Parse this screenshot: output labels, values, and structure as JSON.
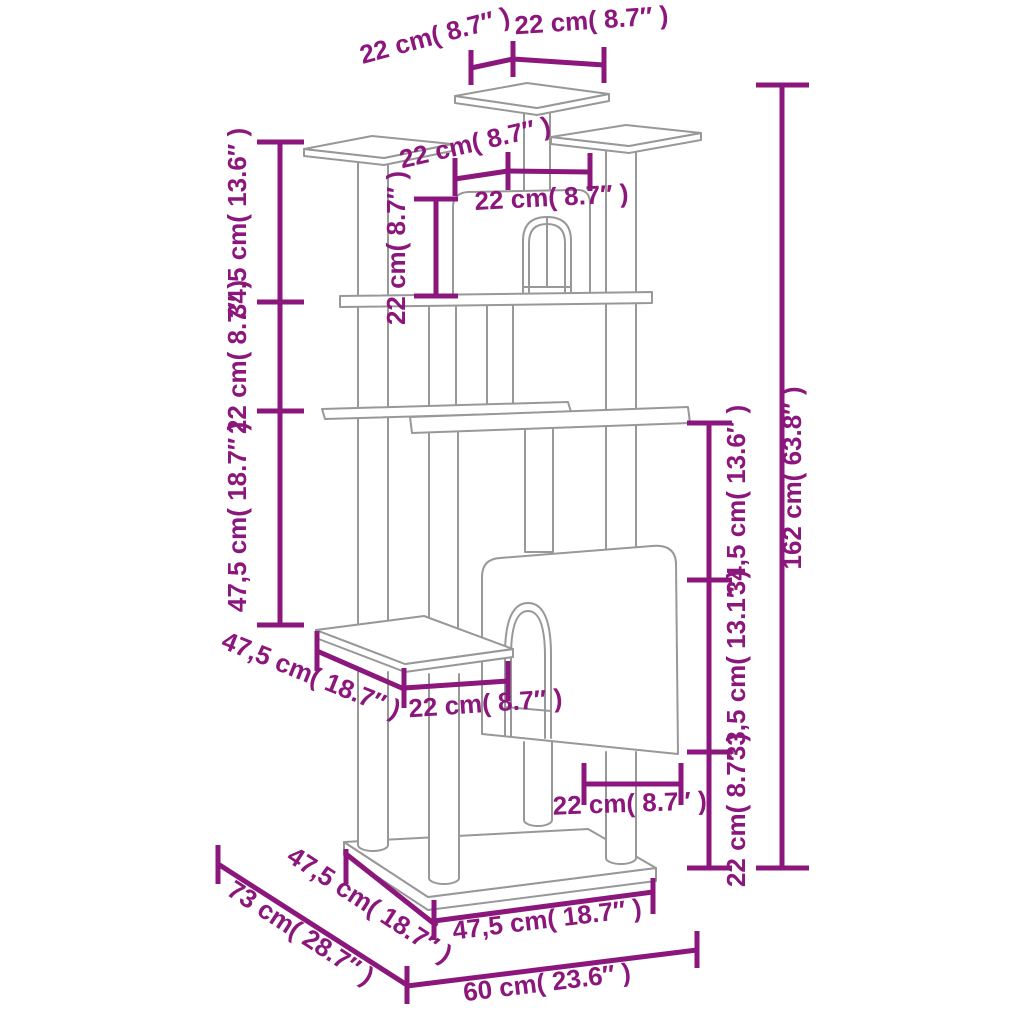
{
  "diagram": {
    "subject": "cat tree with scratching posts - dimension drawing",
    "background": "#ffffff",
    "colors": {
      "dimension_lines": "#8B167C",
      "drawing_outline": "#989898"
    },
    "labels": {
      "top_platform_depth": "22 cm( 8.7″ )",
      "top_platform_width": "22 cm( 8.7″ )",
      "upper_platform_depth": "22 cm( 8.7″ )",
      "upper_house_width": "22 cm( 8.7″ )",
      "upper_house_height": "22 cm( 8.7″ )",
      "left_segment_upper": "34,5 cm( 13.6″ )",
      "left_segment_middle": "22 cm( 8.7″ )",
      "left_segment_lower": "47,5 cm( 18.7″ )",
      "mid_platform_depth": "47,5 cm( 18.7″ )",
      "mid_gap_width": "22 cm( 8.7″ )",
      "lower_house_door_width": "22 cm( 8.7″ )",
      "right_segment_upper": "34,5 cm( 13.6″ )",
      "right_segment_middle": "33,5 cm( 13.1″ )",
      "right_segment_lower": "22 cm( 8.7″ )",
      "total_height": "162 cm( 63.8″ )",
      "base_depth_outer": "73 cm( 28.7″ )",
      "base_depth_left": "47,5 cm( 18.7″ )",
      "base_front_width": "47,5 cm( 18.7″ )",
      "base_total_width": "60 cm( 23.6″ )"
    },
    "measurements": [
      {
        "name": "total height",
        "cm": "162",
        "inch": "63.8"
      },
      {
        "name": "base total width",
        "cm": "60",
        "inch": "23.6"
      },
      {
        "name": "base depth outer",
        "cm": "73",
        "inch": "28.7"
      },
      {
        "name": "base board",
        "cm": "47,5",
        "inch": "18.7"
      },
      {
        "name": "platform / house modules",
        "cm": "22",
        "inch": "8.7"
      },
      {
        "name": "upper section",
        "cm": "34,5",
        "inch": "13.6"
      },
      {
        "name": "lower house section",
        "cm": "33,5",
        "inch": "13.1"
      }
    ]
  }
}
